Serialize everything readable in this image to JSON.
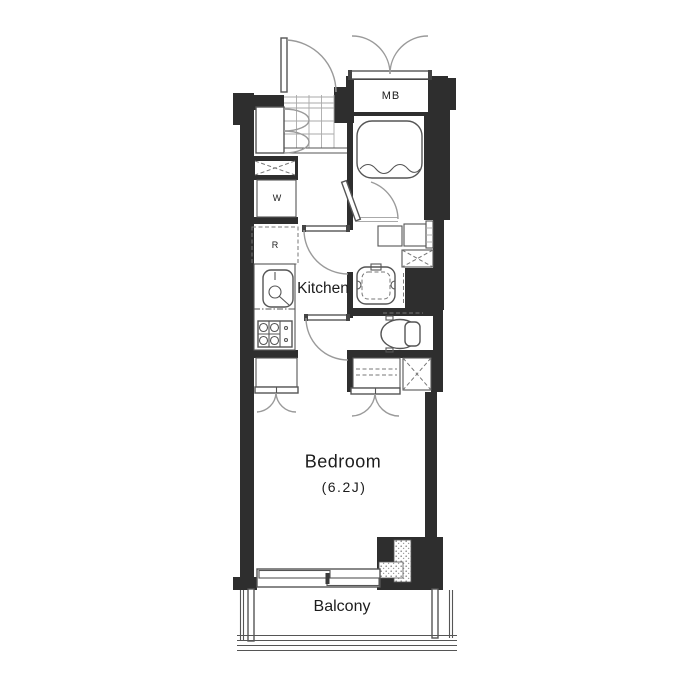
{
  "floorplan": {
    "labels": {
      "meter_box": "MB",
      "washer": "W",
      "refrigerator": "R",
      "kitchen": "Kitchen",
      "bedroom": "Bedroom",
      "bedroom_size": "(6.2J)",
      "balcony": "Balcony"
    },
    "colors": {
      "wall": "#2e2e2e",
      "line": "#555555",
      "arc": "#9a9a9a",
      "background": "#ffffff"
    }
  }
}
